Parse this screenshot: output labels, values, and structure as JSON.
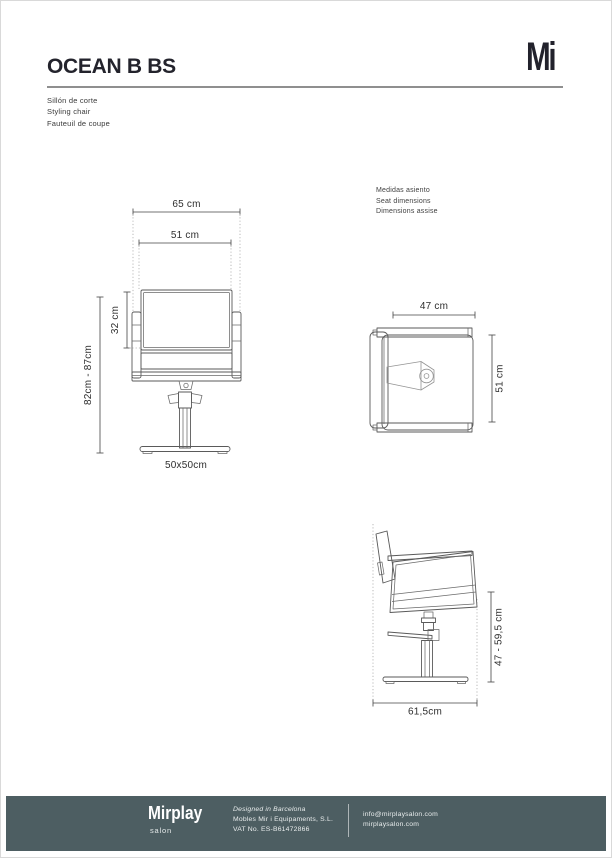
{
  "page": {
    "title": "OCEAN B BS",
    "subtitle_lines": [
      "Sillón de corte",
      "Styling chair",
      "Fauteuil de coupe"
    ],
    "logo_mark": "Mi"
  },
  "drawings": {
    "front_view": {
      "width_total": "65 cm",
      "width_seat": "51 cm",
      "backrest_height": "32 cm",
      "height_range": "82cm - 87cm",
      "base_label": "50x50cm"
    },
    "seat_note": [
      "Medidas asiento",
      "Seat dimensions",
      "Dimensions assise"
    ],
    "top_view": {
      "width_label": "47 cm",
      "depth_label": "51 cm"
    },
    "side_view": {
      "height_label": "47 - 59,5 cm",
      "depth_label": "61,5cm"
    }
  },
  "footer": {
    "brand": "Mirplay",
    "brand_sub": "salon",
    "designed": "Designed in Barcelona",
    "company": "Mobles Mir i Equipaments, S.L.",
    "vat": "VAT No. ES-B61472866",
    "email": "info@mirplaysalon.com",
    "website": "mirplaysalon.com",
    "bg_color": "#4d5e62"
  }
}
